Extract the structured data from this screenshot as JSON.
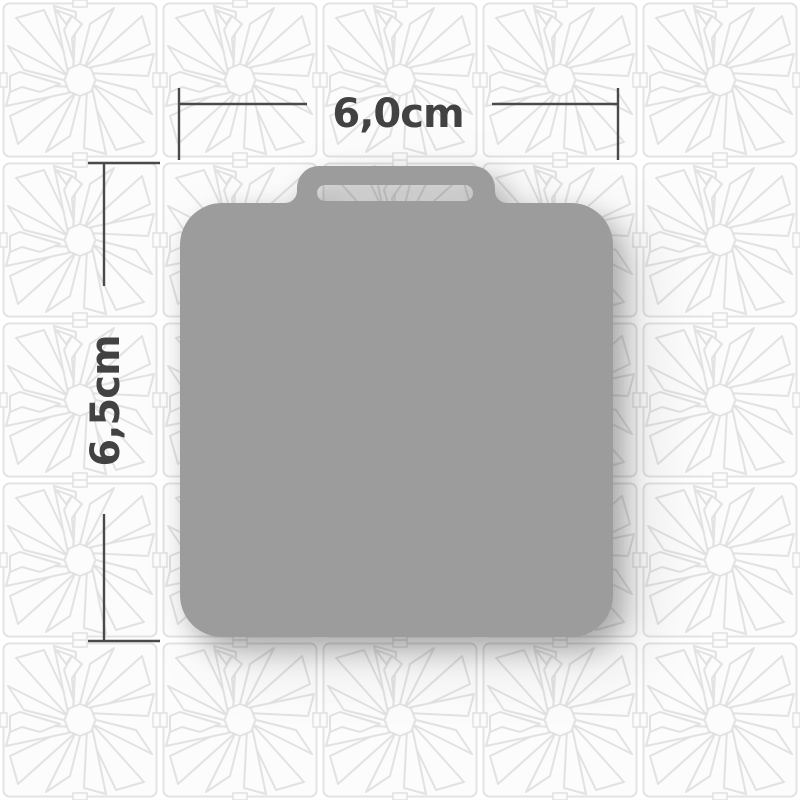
{
  "page": {
    "background_color": "#ffffff",
    "pattern": {
      "name": "origami-crane-star-tiles",
      "line_color": "#e2e2e2",
      "tile_fill": "#fcfcfc"
    }
  },
  "product": {
    "name": "square-tag-with-handle-silhouette",
    "fill_color": "#9c9c9c"
  },
  "dimensions": {
    "width_label": "6,0cm",
    "height_label": "6,5cm",
    "line_color": "#4a4a4a",
    "text_color": "#424242"
  }
}
